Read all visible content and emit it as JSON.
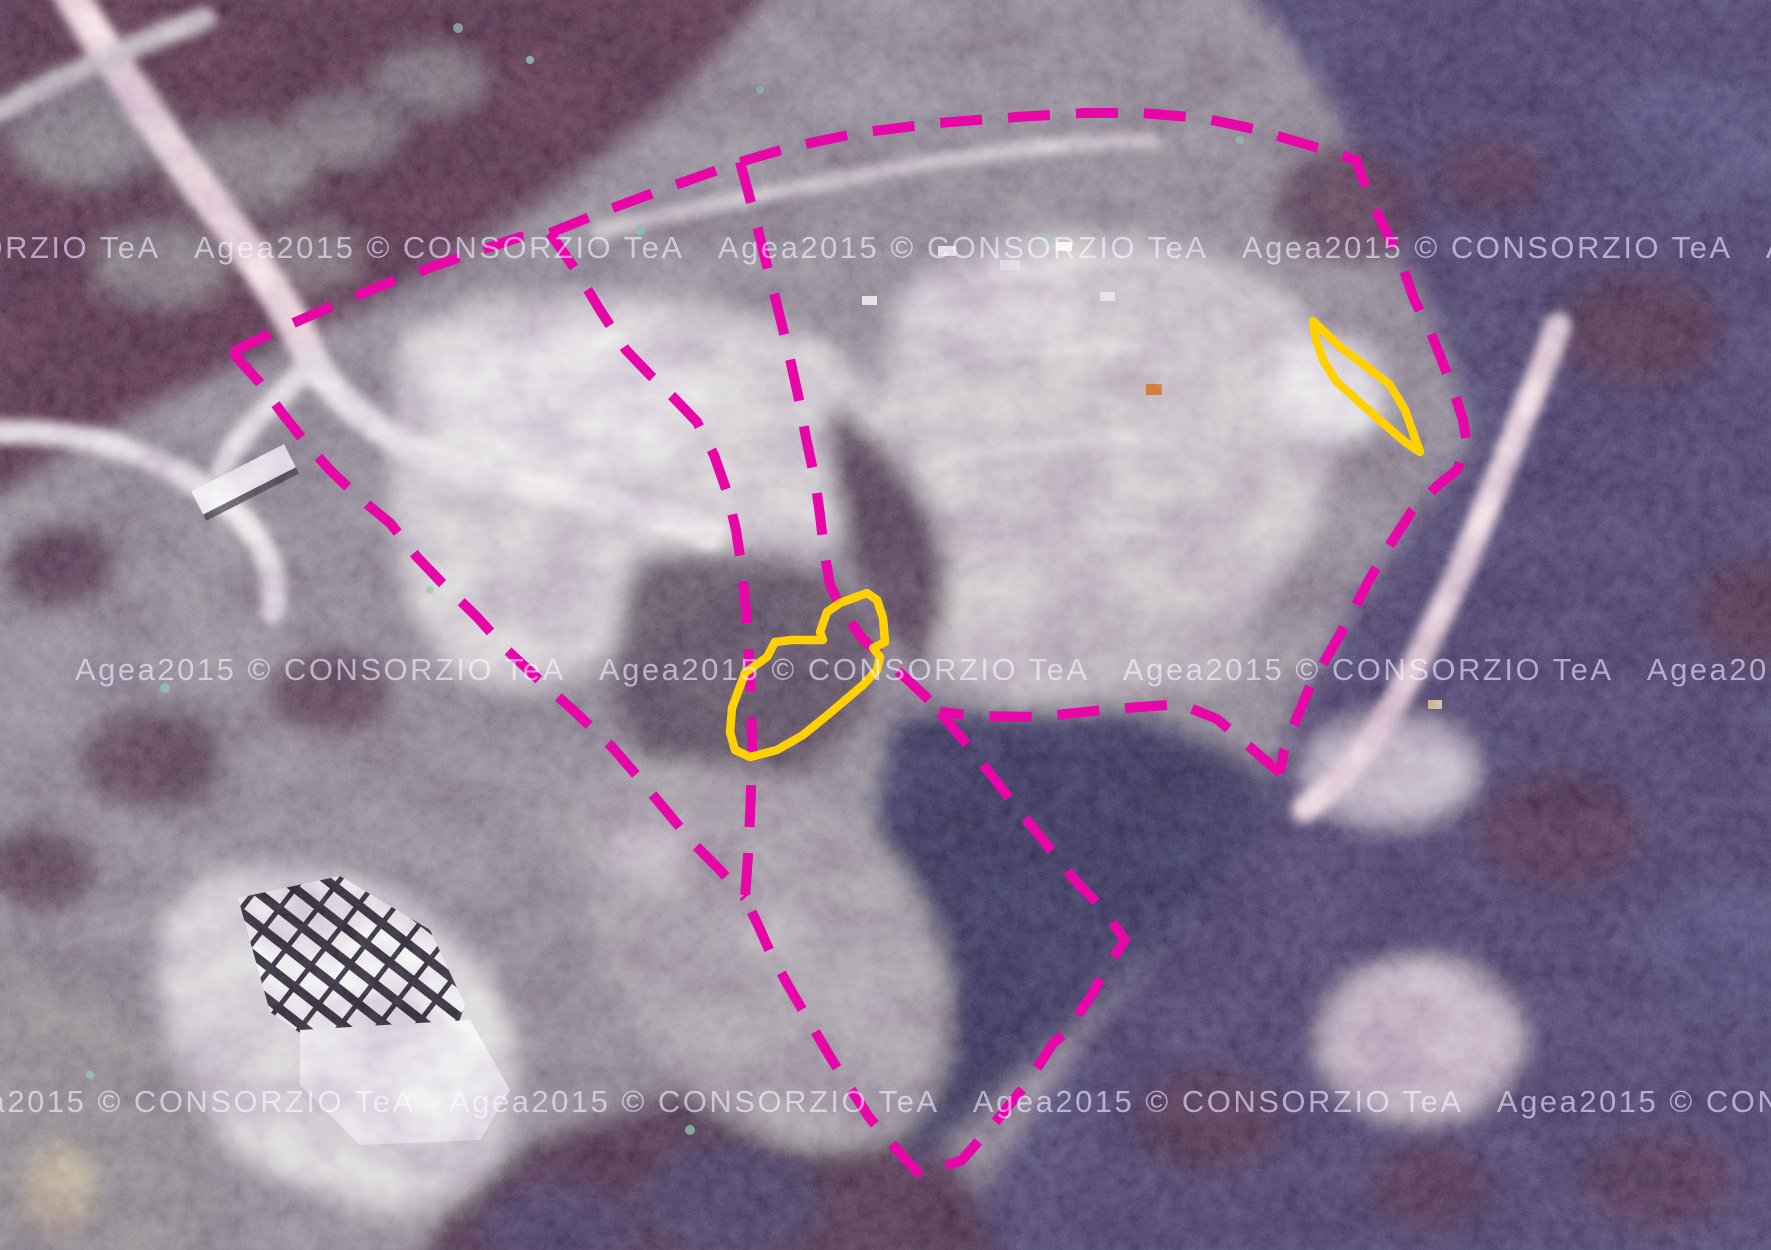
{
  "map": {
    "type": "aerial-orthophoto",
    "provider_watermark": {
      "text": "Agea2015 © CONSORZIO TeA",
      "color": "#a8a0c4",
      "repeat": 5,
      "separator": "   ",
      "rows": [
        {
          "x": -330,
          "y": 258
        },
        {
          "x": 75,
          "y": 680
        },
        {
          "x": -75,
          "y": 1112
        }
      ]
    },
    "overlay": {
      "boundary_color": "#e607a6",
      "boundary_width": 10,
      "boundary_dash": "42 26",
      "parcel_color": "#ffd103",
      "parcel_width": 8.5,
      "boundary_lines": [
        {
          "name": "outer-top-right",
          "points": [
            [
              232,
              352
            ],
            [
              282,
              328
            ],
            [
              339,
              303
            ],
            [
              395,
              280
            ],
            [
              463,
              256
            ],
            [
              520,
              237
            ],
            [
              550,
              233
            ],
            [
              610,
              209
            ],
            [
              678,
              184
            ],
            [
              740,
              162
            ],
            [
              791,
              147
            ],
            [
              858,
              133
            ],
            [
              938,
              123
            ],
            [
              1017,
              117
            ],
            [
              1084,
              113
            ],
            [
              1141,
              113
            ],
            [
              1203,
              118
            ],
            [
              1254,
              129
            ],
            [
              1305,
              144
            ],
            [
              1356,
              160
            ],
            [
              1369,
              196
            ],
            [
              1385,
              229
            ],
            [
              1401,
              262
            ],
            [
              1414,
              299
            ],
            [
              1431,
              333
            ],
            [
              1444,
              366
            ],
            [
              1455,
              395
            ],
            [
              1463,
              420
            ],
            [
              1467,
              445
            ],
            [
              1457,
              470
            ],
            [
              1437,
              486
            ],
            [
              1412,
              511
            ],
            [
              1391,
              543
            ],
            [
              1369,
              580
            ],
            [
              1351,
              615
            ],
            [
              1330,
              652
            ],
            [
              1311,
              684
            ],
            [
              1295,
              722
            ],
            [
              1284,
              750
            ],
            [
              1280,
              773
            ]
          ]
        },
        {
          "name": "notch-west",
          "points": [
            [
              1280,
              773
            ],
            [
              1251,
              748
            ],
            [
              1217,
              719
            ],
            [
              1180,
              704
            ],
            [
              1113,
              709
            ],
            [
              1037,
              717
            ],
            [
              978,
              716
            ],
            [
              940,
              712
            ]
          ]
        },
        {
          "name": "notch-southeast",
          "points": [
            [
              940,
              712
            ],
            [
              978,
              758
            ],
            [
              1013,
              803
            ],
            [
              1047,
              845
            ],
            [
              1073,
              878
            ],
            [
              1100,
              906
            ],
            [
              1125,
              940
            ],
            [
              1113,
              958
            ],
            [
              1089,
              999
            ],
            [
              1064,
              1034
            ],
            [
              1053,
              1043
            ],
            [
              1028,
              1082
            ],
            [
              997,
              1120
            ],
            [
              962,
              1160
            ],
            [
              920,
              1175
            ]
          ]
        },
        {
          "name": "bottom-west",
          "points": [
            [
              920,
              1175
            ],
            [
              888,
              1140
            ],
            [
              869,
              1117
            ],
            [
              848,
              1085
            ],
            [
              829,
              1055
            ],
            [
              809,
              1021
            ],
            [
              789,
              987
            ],
            [
              771,
              954
            ],
            [
              758,
              925
            ],
            [
              745,
              898
            ]
          ]
        },
        {
          "name": "west-edge",
          "points": [
            [
              232,
              352
            ],
            [
              260,
              383
            ],
            [
              282,
              413
            ],
            [
              305,
              442
            ],
            [
              330,
              470
            ],
            [
              358,
              497
            ],
            [
              390,
              523
            ],
            [
              417,
              557
            ],
            [
              442,
              583
            ],
            [
              477,
              617
            ],
            [
              507,
              650
            ],
            [
              537,
              678
            ],
            [
              573,
              710
            ],
            [
              612,
              747
            ],
            [
              638,
              777
            ],
            [
              668,
              813
            ],
            [
              693,
              843
            ],
            [
              720,
              870
            ],
            [
              745,
              898
            ]
          ]
        },
        {
          "name": "inner-division-west",
          "points": [
            [
              550,
              233
            ],
            [
              577,
              272
            ],
            [
              600,
              310
            ],
            [
              626,
              350
            ],
            [
              650,
              375
            ],
            [
              673,
              397
            ],
            [
              697,
              422
            ],
            [
              714,
              455
            ],
            [
              727,
              492
            ],
            [
              736,
              530
            ],
            [
              742,
              570
            ],
            [
              746,
              610
            ],
            [
              749,
              655
            ],
            [
              751,
              700
            ],
            [
              752,
              745
            ],
            [
              751,
              790
            ],
            [
              749,
              840
            ],
            [
              747,
              870
            ],
            [
              745,
              898
            ]
          ]
        },
        {
          "name": "inner-division-east",
          "points": [
            [
              740,
              162
            ],
            [
              753,
              210
            ],
            [
              765,
              258
            ],
            [
              777,
              305
            ],
            [
              788,
              350
            ],
            [
              798,
              395
            ],
            [
              806,
              438
            ],
            [
              815,
              480
            ],
            [
              820,
              515
            ],
            [
              824,
              550
            ],
            [
              830,
              585
            ],
            [
              843,
              612
            ],
            [
              862,
              638
            ],
            [
              885,
              660
            ],
            [
              908,
              680
            ],
            [
              925,
              696
            ],
            [
              940,
              712
            ]
          ]
        }
      ],
      "parcel_outlines": [
        {
          "name": "parcel-central",
          "points": [
            [
              867,
              593
            ],
            [
              840,
              603
            ],
            [
              827,
              612
            ],
            [
              820,
              632
            ],
            [
              823,
              640
            ],
            [
              792,
              640
            ],
            [
              775,
              642
            ],
            [
              767,
              657
            ],
            [
              745,
              673
            ],
            [
              732,
              708
            ],
            [
              730,
              732
            ],
            [
              735,
              750
            ],
            [
              750,
              757
            ],
            [
              777,
              750
            ],
            [
              803,
              735
            ],
            [
              830,
              713
            ],
            [
              863,
              685
            ],
            [
              877,
              670
            ],
            [
              880,
              657
            ],
            [
              873,
              648
            ],
            [
              885,
              642
            ],
            [
              883,
              618
            ],
            [
              877,
              600
            ]
          ]
        },
        {
          "name": "parcel-northeast",
          "points": [
            [
              1313,
              321
            ],
            [
              1340,
              347
            ],
            [
              1367,
              367
            ],
            [
              1390,
              385
            ],
            [
              1405,
              410
            ],
            [
              1415,
              438
            ],
            [
              1420,
              452
            ],
            [
              1405,
              442
            ],
            [
              1383,
              423
            ],
            [
              1357,
              400
            ],
            [
              1337,
              382
            ],
            [
              1324,
              362
            ],
            [
              1316,
              340
            ]
          ]
        }
      ]
    }
  }
}
